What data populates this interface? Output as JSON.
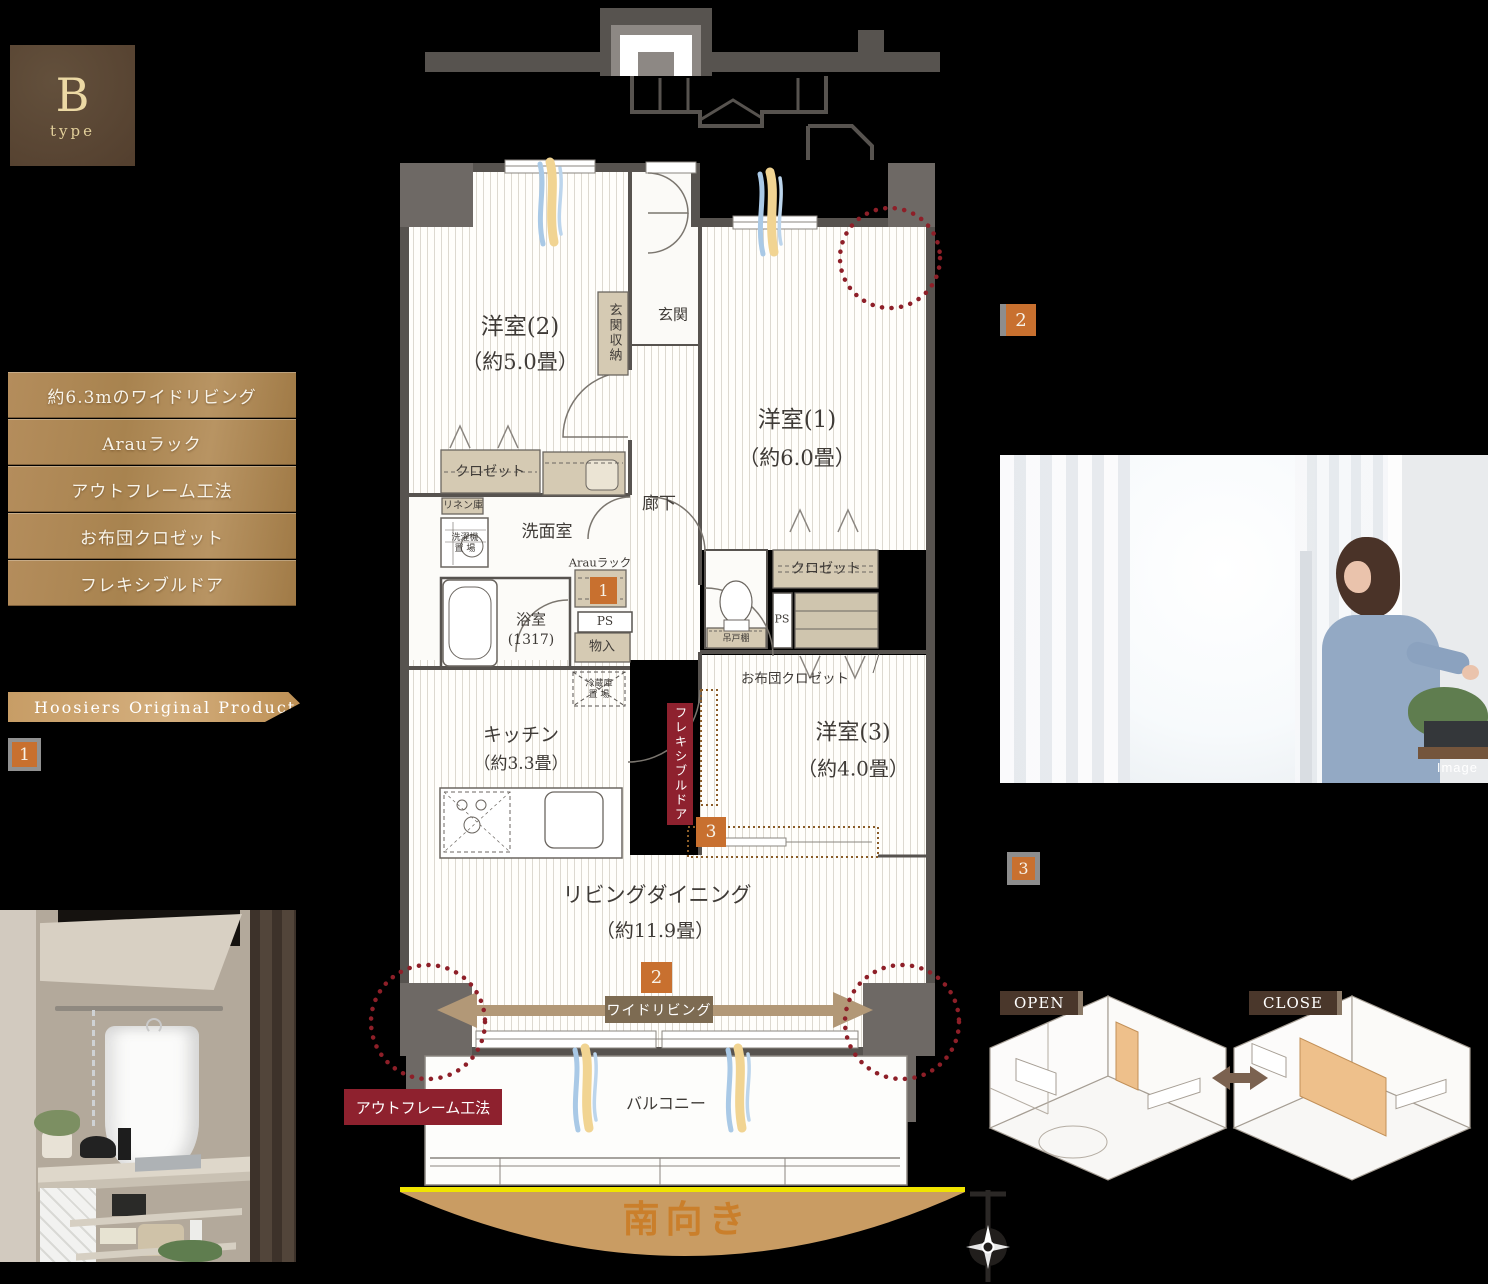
{
  "badge": {
    "letter": "B",
    "sub": "type"
  },
  "features": [
    "約6.3mのワイドリビング",
    "Arauラック",
    "アウトフレーム工法",
    "お布団クロゼット",
    "フレキシブルドア"
  ],
  "ribbon": {
    "label": "Hoosiers Original Product"
  },
  "markers": {
    "left1": "1",
    "right2": "2",
    "right3": "3",
    "plan1": "1",
    "plan2": "2",
    "plan3": "3"
  },
  "plan": {
    "room2": "洋室(2)",
    "room2_size": "（約5.0畳）",
    "room1": "洋室(1)",
    "room1_size": "（約6.0畳）",
    "room3": "洋室(3)",
    "room3_size": "（約4.0畳）",
    "ld": "リビングダイニング",
    "ld_size": "（約11.9畳）",
    "kitchen": "キッチン",
    "kitchen_size": "（約3.3畳）",
    "genkan": "玄関",
    "genkan_storage": "玄関収納",
    "closet_room2": "クロゼット",
    "closet_room1": "クロゼット",
    "linen": "リネン庫",
    "washer_l1": "洗濯機",
    "washer_l2": "置 場",
    "washroom": "洗面室",
    "arau": "Arauラック",
    "corridor": "廊下",
    "bath": "浴室",
    "bath_size": "(1317)",
    "ps1": "PS",
    "ps2": "PS",
    "mono": "物入",
    "hanging": "吊戸棚",
    "futon": "お布団クロゼット",
    "fridge_l1": "冷蔵庫",
    "fridge_l2": "置 場",
    "balcony": "バルコニー",
    "south": "南向き",
    "wide_living": "ワイドリビング",
    "flexible_door": "フレキシブルドア",
    "outframe": "アウトフレーム工法"
  },
  "photo": {
    "caption": "Image"
  },
  "iso": {
    "open": "OPEN",
    "close": "CLOSE"
  },
  "colors": {
    "accent_orange": "#c8702f",
    "deep_red": "#8e212e",
    "ribbon_tan": "#c79d66",
    "wall_gray": "#57534f",
    "fixture_tan": "#d5cab3",
    "south_yellow": "#f0e400",
    "south_text": "#ca7f2b"
  }
}
